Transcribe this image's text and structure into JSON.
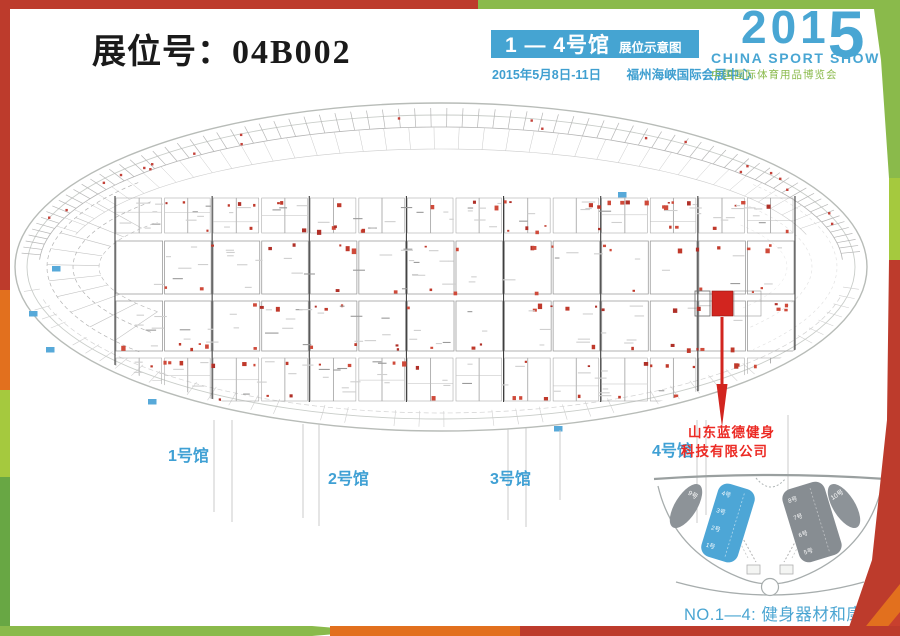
{
  "header": {
    "booth_label": "展位号：",
    "booth_number": "04B002",
    "hall_banner": "1 — 4号馆",
    "hall_banner_sub": "展位示意图",
    "date": "2015年5月8日-11日",
    "venue": "福州海峡国际会展中心",
    "logo_year_prefix": "201",
    "logo_year_suffix": "5",
    "logo_title": "CHINA SPORT SHOW",
    "logo_subtitle": "中国国际体育用品博览会"
  },
  "map": {
    "hall_labels": [
      {
        "label": "1号馆"
      },
      {
        "label": "2号馆"
      },
      {
        "label": "3号馆"
      },
      {
        "label": "4号馆"
      }
    ],
    "company_line1": "山东蓝德健身",
    "company_line2": "科技有限公司",
    "highlighted_booth": "04B002"
  },
  "minimap": {
    "blue_hall_labels": [
      "4号",
      "3号",
      "2号",
      "1号"
    ],
    "gray_hall_labels": [
      "8号",
      "7号",
      "6号",
      "5号"
    ],
    "left_oval_label": "9号",
    "right_oval_label": "10号"
  },
  "footer": {
    "caption": "NO.1—4: 健身器材和康复设备"
  },
  "colors": {
    "accent_blue": "#45a4d2",
    "accent_green": "#8aba4b",
    "frame_red": "#bd3b2c",
    "frame_orange": "#e2701e",
    "frame_light_green": "#a5c93e",
    "frame_green": "#68a744",
    "booth_highlight_red": "#d2251f",
    "company_red": "#ec2a24"
  }
}
